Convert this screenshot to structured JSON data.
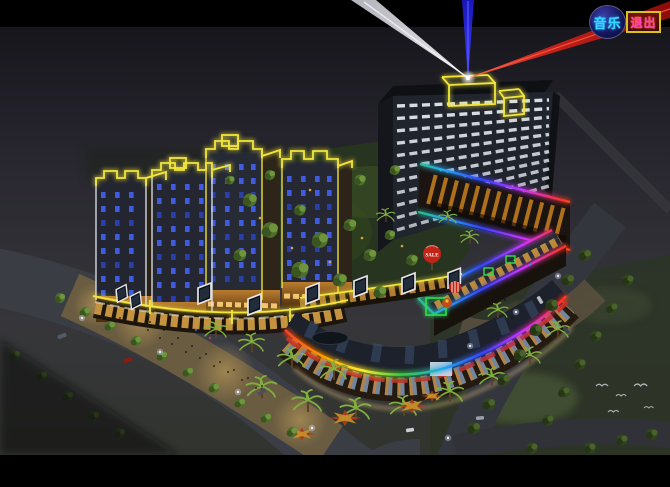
{
  "controls": {
    "music_button": {
      "label": "音乐",
      "text_color": "#35d8ff",
      "shape": "circle",
      "fill": "#16165c"
    },
    "exit_button": {
      "label": "退出",
      "text_color": "#ff3ccc",
      "border_color": "#d8c21c",
      "fill": "#4a0c04"
    }
  },
  "scene": {
    "balloon_label": "SALE",
    "colors": {
      "letterbox": "#000000",
      "sky_top": "#17161d",
      "sky_bottom": "#31342e",
      "neon_yellow": "#f2e63c",
      "neon_white": "#e4e9f0",
      "neon_green": "#2ee04a",
      "rainbow": [
        "#ff3322",
        "#ff9900",
        "#ffee33",
        "#33cc44",
        "#22aaee",
        "#3344ff",
        "#cc33ff"
      ],
      "beam_white": "#e6e6ec",
      "beam_blue": "#2a2ae0",
      "beam_red": "#cc1910",
      "window_white": "#e2e7ef",
      "window_blue": "#3f5ce0",
      "facade_warm": "#cf9a43",
      "podium_amber": "#c07a1d",
      "pond_teal": "#1d858d",
      "balloon_red": "#c22418",
      "lawn_green": "#273420",
      "plaza_tan": "#6d5e41",
      "road_gray": "#3b3d44"
    }
  }
}
